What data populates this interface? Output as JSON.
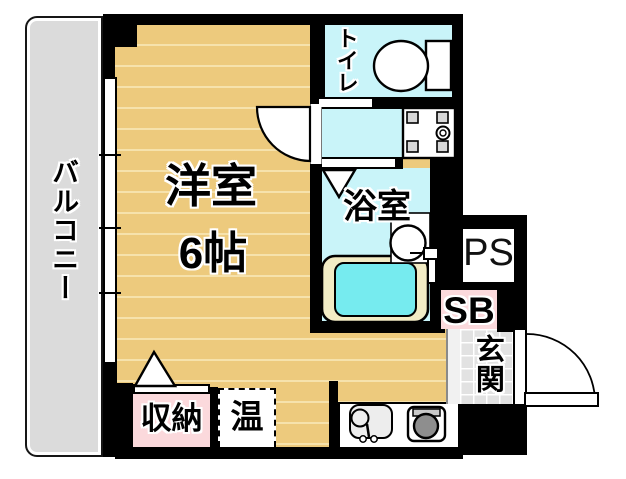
{
  "floorplan": {
    "balcony": "バルコニー",
    "room_label": "洋室",
    "room_size": "6帖",
    "toilet": "トイレ",
    "bathroom": "浴室",
    "entrance": "玄関",
    "storage": "収納",
    "water_heater": "温",
    "pipe_shaft": "PS",
    "shoe_box": "SB"
  },
  "colors": {
    "tan": "#EDCA7D",
    "stripe": "#F6E2AC",
    "cyan": "#C9F4F9",
    "tubcyan": "#76EBEF",
    "cream": "#F2ECC5",
    "pink": "#FBD9DC",
    "balconygray": "#DBDBDB",
    "tilegray": "#E2E2E2",
    "wall": "#000000"
  }
}
